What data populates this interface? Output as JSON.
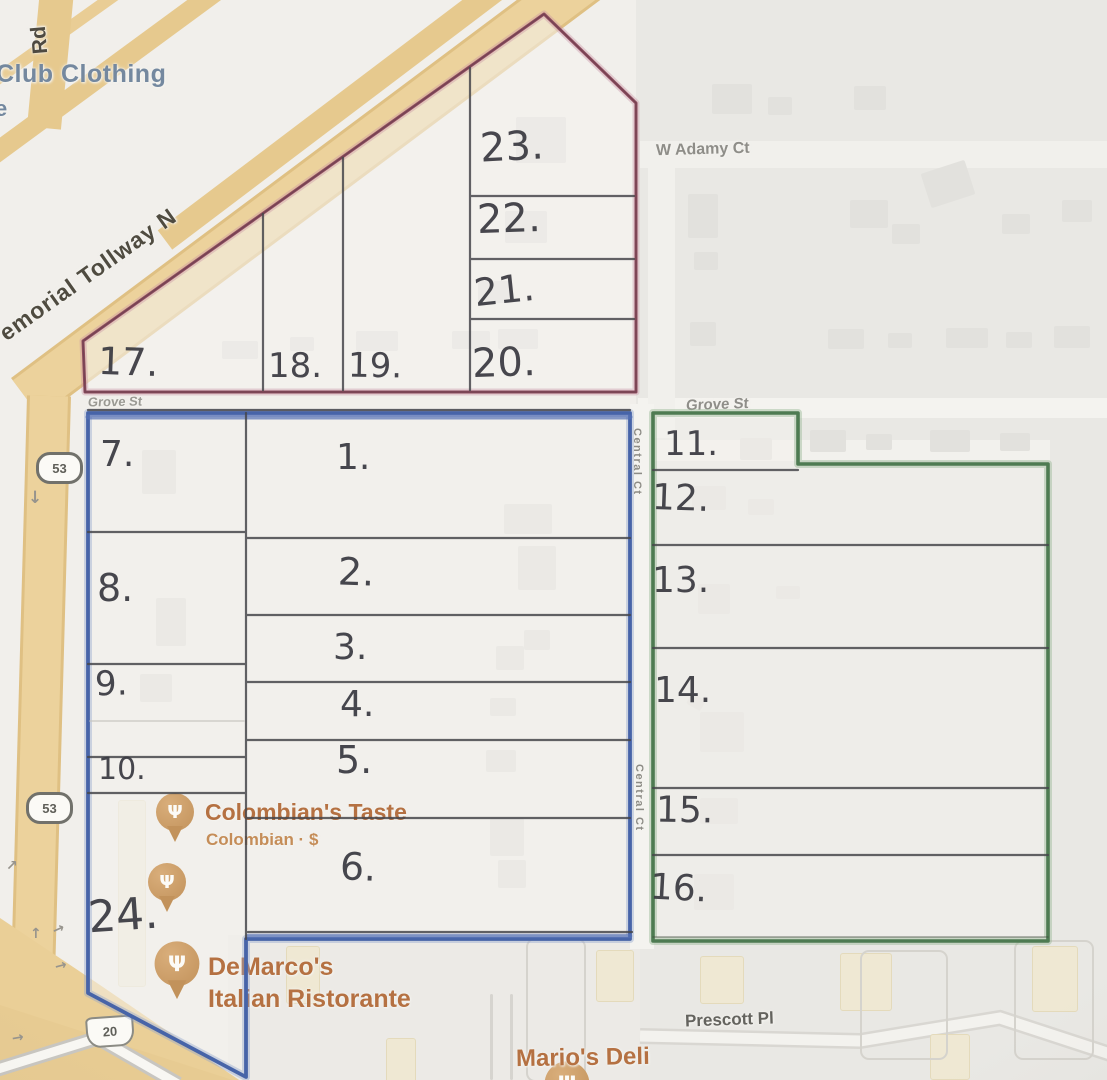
{
  "road_labels": {
    "rd": "Rd",
    "memorial_tollway": "emorial Tollway N",
    "w_adamy_ct": "W Adamy Ct",
    "grove_st_west": "Grove St",
    "grove_st_east": "Grove St",
    "central_ct_upper": "Central Ct",
    "central_ct_lower": "Central Ct",
    "prescott_pl": "Prescott Pl"
  },
  "route_shields": {
    "shield_53_north": "53",
    "shield_53_south": "53",
    "shield_20": "20"
  },
  "pois": {
    "club_clothing": "Club Clothing",
    "club_clothing_fragment": "e",
    "colombians_taste": {
      "name": "Colombian's Taste",
      "detail": "Colombian · $"
    },
    "demarcos": {
      "line1": "DeMarco's",
      "line2": "Italian Ristorante"
    },
    "marios_deli": "Mario's Deli"
  },
  "lot_numbers": {
    "red_block": {
      "lot17": "17.",
      "lot18": "18.",
      "lot19": "19.",
      "lot20": "20.",
      "lot21": "21.",
      "lot22": "22.",
      "lot23": "23."
    },
    "blue_block": {
      "lot1": "1.",
      "lot2": "2.",
      "lot3": "3.",
      "lot4": "4.",
      "lot5": "5.",
      "lot6": "6.",
      "lot7": "7.",
      "lot8": "8.",
      "lot9": "9.",
      "lot10": "10.",
      "lot24": "24."
    },
    "green_block": {
      "lot11": "11.",
      "lot12": "12.",
      "lot13": "13.",
      "lot14": "14.",
      "lot15": "15.",
      "lot16": "16."
    }
  },
  "icons": {
    "restaurant_pin_glyph": "Ψ",
    "arrow_down": "↓",
    "arrow_up_right": "↗",
    "arrow_up": "↑",
    "arrow_right": "→"
  },
  "colors": {
    "red_outline": "#8e4a5e",
    "blue_outline": "#4764a8",
    "green_outline": "#4e7b52",
    "road_yellow": "#eacf97",
    "poi_orange": "#b57142",
    "poi_blue_gray": "#74889f",
    "pencil_gray": "#45454b"
  }
}
